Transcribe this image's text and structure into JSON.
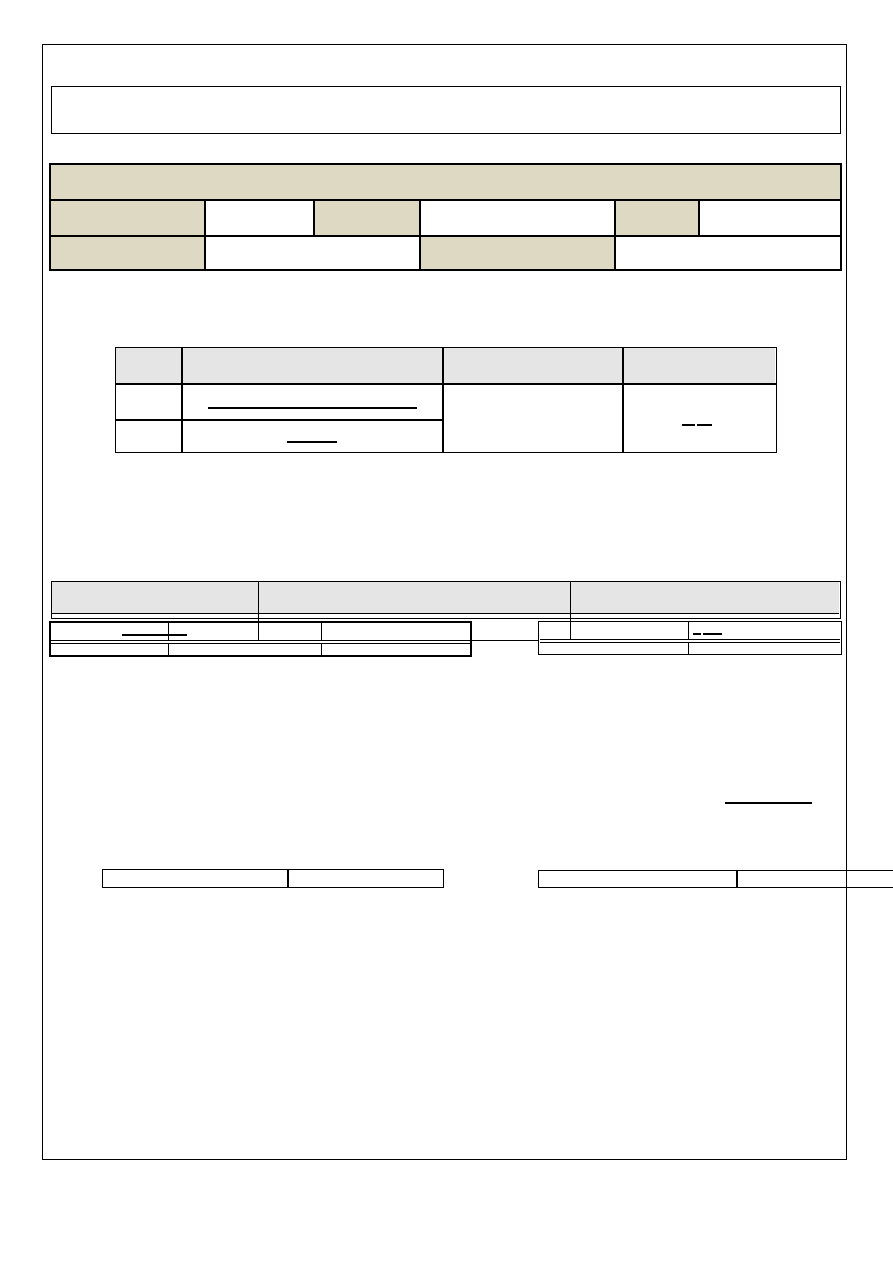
{
  "meta": {
    "description": "Blank single-page printable form template: outlined page frame, empty top box, shaded banner table, two gray-header tables, fill-in underlines and two small two-cell footer tables. No visible text anywhere on the page.",
    "visible_text": ""
  },
  "colors": {
    "page_bg": "#ffffff",
    "ink": "#000000",
    "tan_fill": "#ddd9c3",
    "gray_fill": "#e5e5e5"
  },
  "sections": [
    {
      "name": "page-frame",
      "kind": "border"
    },
    {
      "name": "top-outlined-box",
      "kind": "empty box"
    },
    {
      "name": "tan-banner-table",
      "kind": "table",
      "rows": 3,
      "shaded_fill": "#ddd9c3"
    },
    {
      "name": "gray-header-table-small",
      "kind": "table",
      "columns": 4,
      "header_fill": "#e5e5e5",
      "fill_in_lines": 3
    },
    {
      "name": "gray-header-section-wide",
      "kind": "table group",
      "header_cells": 3,
      "header_fill": "#e5e5e5",
      "sub_tables": 2
    },
    {
      "name": "standalone-fill-in-line",
      "kind": "underline"
    },
    {
      "name": "bottom-left-two-cell-table",
      "kind": "table",
      "columns": 2
    },
    {
      "name": "bottom-right-two-cell-table",
      "kind": "table",
      "columns": 2,
      "clipped_at_page_edge": true
    }
  ]
}
